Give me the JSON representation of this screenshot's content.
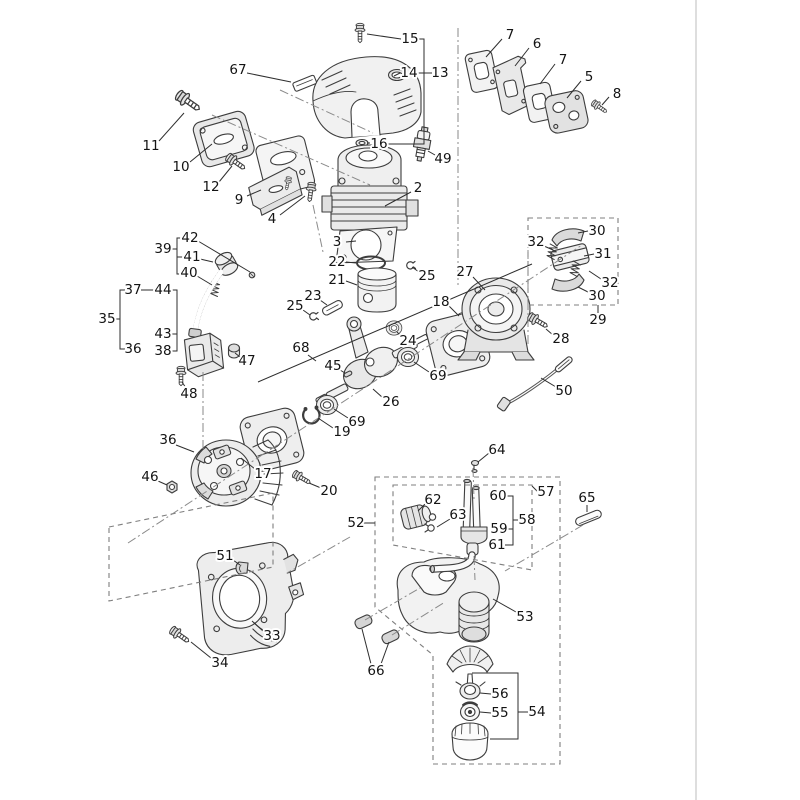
{
  "meta": {
    "width": 800,
    "height": 800,
    "background": "#ffffff"
  },
  "style": {
    "line_color": "#3d3d3d",
    "label_color": "#141414",
    "fill_light": "#ececec",
    "dash_color": "#7f7f7f",
    "centerline_color": "#8a8a8a",
    "divider_color": "#bdbdbd",
    "divider_x": 696
  },
  "diagram": {
    "labels": [
      {
        "n": "15",
        "x": 410,
        "y": 39
      },
      {
        "n": "67",
        "x": 238,
        "y": 70
      },
      {
        "n": "14",
        "x": 409,
        "y": 73
      },
      {
        "n": "13",
        "x": 440,
        "y": 73
      },
      {
        "n": "7",
        "x": 510,
        "y": 35
      },
      {
        "n": "6",
        "x": 537,
        "y": 44
      },
      {
        "n": "7",
        "x": 563,
        "y": 60
      },
      {
        "n": "5",
        "x": 589,
        "y": 77
      },
      {
        "n": "8",
        "x": 617,
        "y": 94
      },
      {
        "n": "11",
        "x": 151,
        "y": 146
      },
      {
        "n": "10",
        "x": 181,
        "y": 167
      },
      {
        "n": "16",
        "x": 379,
        "y": 144
      },
      {
        "n": "49",
        "x": 443,
        "y": 159
      },
      {
        "n": "12",
        "x": 211,
        "y": 187
      },
      {
        "n": "9",
        "x": 239,
        "y": 200
      },
      {
        "n": "2",
        "x": 418,
        "y": 188
      },
      {
        "n": "4",
        "x": 272,
        "y": 219
      },
      {
        "n": "3",
        "x": 337,
        "y": 242
      },
      {
        "n": "22",
        "x": 337,
        "y": 262
      },
      {
        "n": "42",
        "x": 190,
        "y": 238
      },
      {
        "n": "39",
        "x": 163,
        "y": 249
      },
      {
        "n": "41",
        "x": 192,
        "y": 257
      },
      {
        "n": "40",
        "x": 189,
        "y": 273
      },
      {
        "n": "21",
        "x": 337,
        "y": 280
      },
      {
        "n": "25",
        "x": 427,
        "y": 276
      },
      {
        "n": "37",
        "x": 133,
        "y": 290
      },
      {
        "n": "44",
        "x": 163,
        "y": 290
      },
      {
        "n": "23",
        "x": 313,
        "y": 296
      },
      {
        "n": "27",
        "x": 465,
        "y": 272
      },
      {
        "n": "30",
        "x": 597,
        "y": 231
      },
      {
        "n": "32",
        "x": 536,
        "y": 242
      },
      {
        "n": "31",
        "x": 603,
        "y": 254
      },
      {
        "n": "25",
        "x": 295,
        "y": 306
      },
      {
        "n": "35",
        "x": 107,
        "y": 319
      },
      {
        "n": "18",
        "x": 441,
        "y": 302
      },
      {
        "n": "32",
        "x": 610,
        "y": 283
      },
      {
        "n": "30",
        "x": 597,
        "y": 296
      },
      {
        "n": "29",
        "x": 598,
        "y": 320
      },
      {
        "n": "36",
        "x": 133,
        "y": 349
      },
      {
        "n": "43",
        "x": 163,
        "y": 334
      },
      {
        "n": "38",
        "x": 163,
        "y": 351
      },
      {
        "n": "28",
        "x": 561,
        "y": 339
      },
      {
        "n": "47",
        "x": 247,
        "y": 361
      },
      {
        "n": "68",
        "x": 301,
        "y": 348
      },
      {
        "n": "24",
        "x": 408,
        "y": 341
      },
      {
        "n": "69",
        "x": 438,
        "y": 376
      },
      {
        "n": "45",
        "x": 333,
        "y": 366
      },
      {
        "n": "48",
        "x": 189,
        "y": 394
      },
      {
        "n": "26",
        "x": 391,
        "y": 402
      },
      {
        "n": "50",
        "x": 564,
        "y": 391
      },
      {
        "n": "19",
        "x": 342,
        "y": 432
      },
      {
        "n": "69",
        "x": 357,
        "y": 422
      },
      {
        "n": "36",
        "x": 168,
        "y": 440
      },
      {
        "n": "17",
        "x": 263,
        "y": 474
      },
      {
        "n": "46",
        "x": 150,
        "y": 477
      },
      {
        "n": "20",
        "x": 329,
        "y": 491
      },
      {
        "n": "64",
        "x": 497,
        "y": 450
      },
      {
        "n": "60",
        "x": 498,
        "y": 496
      },
      {
        "n": "57",
        "x": 546,
        "y": 492
      },
      {
        "n": "62",
        "x": 433,
        "y": 500
      },
      {
        "n": "65",
        "x": 587,
        "y": 498
      },
      {
        "n": "63",
        "x": 458,
        "y": 515
      },
      {
        "n": "58",
        "x": 527,
        "y": 520
      },
      {
        "n": "52",
        "x": 356,
        "y": 523
      },
      {
        "n": "59",
        "x": 499,
        "y": 529
      },
      {
        "n": "61",
        "x": 497,
        "y": 545
      },
      {
        "n": "51",
        "x": 225,
        "y": 556
      },
      {
        "n": "53",
        "x": 525,
        "y": 617
      },
      {
        "n": "33",
        "x": 272,
        "y": 636
      },
      {
        "n": "34",
        "x": 220,
        "y": 663
      },
      {
        "n": "66",
        "x": 376,
        "y": 671
      },
      {
        "n": "56",
        "x": 500,
        "y": 694
      },
      {
        "n": "55",
        "x": 500,
        "y": 713
      },
      {
        "n": "54",
        "x": 537,
        "y": 712
      }
    ],
    "leaders": [
      [
        401,
        39,
        367,
        34
      ],
      [
        247,
        73,
        291,
        82
      ],
      [
        400,
        73,
        394,
        76
      ],
      [
        502,
        39,
        486,
        57
      ],
      [
        529,
        48,
        515,
        66
      ],
      [
        555,
        64,
        540,
        84
      ],
      [
        581,
        81,
        567,
        98
      ],
      [
        609,
        97,
        602,
        105
      ],
      [
        159,
        141,
        184,
        113
      ],
      [
        190,
        162,
        212,
        144
      ],
      [
        370,
        143,
        367,
        143
      ],
      [
        435,
        155,
        428,
        151
      ],
      [
        219,
        182,
        232,
        166
      ],
      [
        247,
        196,
        261,
        190
      ],
      [
        411,
        192,
        385,
        206
      ],
      [
        280,
        215,
        305,
        196
      ],
      [
        346,
        242,
        356,
        241
      ],
      [
        346,
        262,
        356,
        263
      ],
      [
        346,
        281,
        357,
        285
      ],
      [
        419,
        272,
        412,
        267
      ],
      [
        320,
        300,
        327,
        305
      ],
      [
        303,
        310,
        310,
        315
      ],
      [
        198,
        241,
        250,
        272
      ],
      [
        200,
        259,
        213,
        262
      ],
      [
        197,
        276,
        212,
        285
      ],
      [
        473,
        277,
        485,
        290
      ],
      [
        588,
        231,
        578,
        233
      ],
      [
        544,
        246,
        553,
        250
      ],
      [
        594,
        254,
        584,
        256
      ],
      [
        601,
        279,
        589,
        271
      ],
      [
        588,
        292,
        578,
        287
      ],
      [
        449,
        306,
        459,
        316
      ],
      [
        553,
        335,
        546,
        329
      ],
      [
        340,
        370,
        345,
        373
      ],
      [
        402,
        337,
        397,
        332
      ],
      [
        429,
        372,
        414,
        362
      ],
      [
        383,
        398,
        373,
        389
      ],
      [
        348,
        418,
        334,
        409
      ],
      [
        333,
        428,
        318,
        418
      ],
      [
        240,
        357,
        235,
        353
      ],
      [
        186,
        388,
        182,
        382
      ],
      [
        176,
        445,
        194,
        452
      ],
      [
        255,
        469,
        241,
        458
      ],
      [
        158,
        481,
        167,
        485
      ],
      [
        321,
        488,
        309,
        483
      ],
      [
        233,
        560,
        240,
        565
      ],
      [
        263,
        631,
        252,
        621
      ],
      [
        211,
        658,
        191,
        642
      ],
      [
        489,
        453,
        478,
        462
      ],
      [
        425,
        504,
        418,
        511
      ],
      [
        450,
        519,
        437,
        527
      ],
      [
        587,
        505,
        587,
        512
      ],
      [
        516,
        612,
        493,
        599
      ],
      [
        371,
        664,
        362,
        629
      ],
      [
        381,
        664,
        389,
        642
      ],
      [
        491,
        694,
        480,
        693
      ],
      [
        491,
        713,
        480,
        712
      ],
      [
        556,
        387,
        541,
        378
      ]
    ],
    "brackets": [
      [
        414,
        39,
        424,
        39,
        424,
        144,
        388,
        144
      ],
      [
        417,
        73,
        432,
        73
      ],
      [
        115,
        319,
        120,
        319
      ],
      [
        125,
        290,
        120,
        290,
        120,
        349,
        125,
        349
      ],
      [
        141,
        290,
        177,
        290,
        177,
        351,
        172,
        351
      ],
      [
        171,
        334,
        177,
        334
      ],
      [
        171,
        249,
        177,
        249
      ],
      [
        182,
        238,
        177,
        238,
        177,
        274,
        182,
        274
      ],
      [
        184,
        257,
        177,
        257
      ],
      [
        505,
        496,
        513,
        496,
        513,
        545,
        505,
        545
      ],
      [
        507,
        529,
        513,
        529
      ],
      [
        513,
        520,
        518,
        520
      ],
      [
        538,
        492,
        532,
        486
      ],
      [
        472,
        673,
        518,
        673,
        518,
        739,
        490,
        739
      ],
      [
        518,
        712,
        528,
        712
      ],
      [
        598,
        305,
        598,
        313
      ],
      [
        363,
        523,
        375,
        523
      ],
      [
        308,
        355,
        316,
        361
      ],
      [
        258,
        382,
        532,
        264
      ]
    ],
    "dash_dot_lines": [
      [
        128,
        543,
        582,
        245
      ],
      [
        280,
        90,
        373,
        133
      ],
      [
        458,
        28,
        458,
        285
      ],
      [
        528,
        250,
        528,
        345
      ],
      [
        203,
        372,
        203,
        452
      ],
      [
        583,
        525,
        505,
        571
      ],
      [
        473,
        468,
        474,
        499
      ],
      [
        365,
        620,
        420,
        588
      ],
      [
        392,
        635,
        445,
        602
      ],
      [
        350,
        537,
        287,
        573
      ],
      [
        212,
        115,
        370,
        185
      ],
      [
        313,
        205,
        323,
        252
      ],
      [
        474,
        556,
        475,
        580
      ]
    ],
    "dash_boxes": [
      [
        528,
        218,
        618,
        218,
        618,
        305,
        528,
        305
      ],
      [
        109,
        527,
        273,
        493,
        273,
        567,
        109,
        601
      ],
      [
        375,
        477,
        560,
        477,
        560,
        764,
        433,
        764,
        433,
        655,
        375,
        607
      ],
      [
        393,
        485,
        532,
        485,
        532,
        570,
        393,
        545
      ]
    ]
  }
}
